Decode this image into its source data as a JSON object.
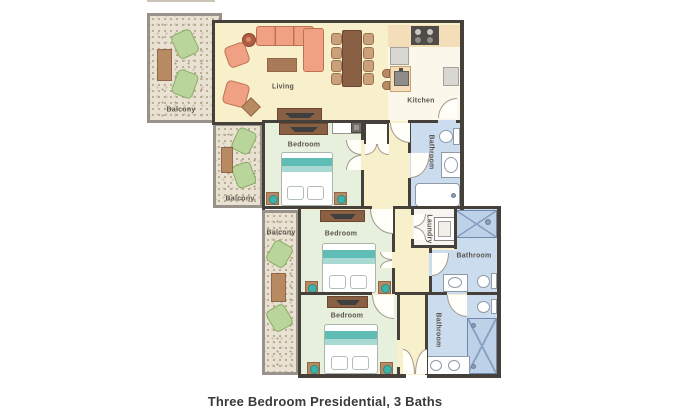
{
  "plan": {
    "caption": "Three Bedroom Presidential, 3 Baths",
    "labels": {
      "living": "Living",
      "kitchen": "Kitchen",
      "bedroom_1": "Bedroom",
      "bedroom_2": "Bedroom",
      "bedroom_3": "Bedroom",
      "balcony_1": "Balcony",
      "balcony_2": "Balcony",
      "balcony_3": "Balcony",
      "bathroom_1": "Bathroom",
      "bathroom_2": "Bathroom",
      "bathroom_3": "Bathroom",
      "laundry": "Laundry"
    }
  },
  "colors": {
    "wall": "#45403a",
    "floor_main": "#f8f0cb",
    "floor_kitchen": "#fbf7ea",
    "floor_bedroom": "#e7f0dd",
    "floor_bathroom": "#cbdcee",
    "floor_shower": "#bdd1e8",
    "balcony_tan": "#e9e2d3",
    "sofa_coral": "#f0a183",
    "wood_brown": "#b78a62",
    "wood_dark": "#8a6045",
    "bed_teal": "#5fbdb5",
    "balcony_chair_green": "#b9d59b",
    "label_text": "#5a544c"
  }
}
